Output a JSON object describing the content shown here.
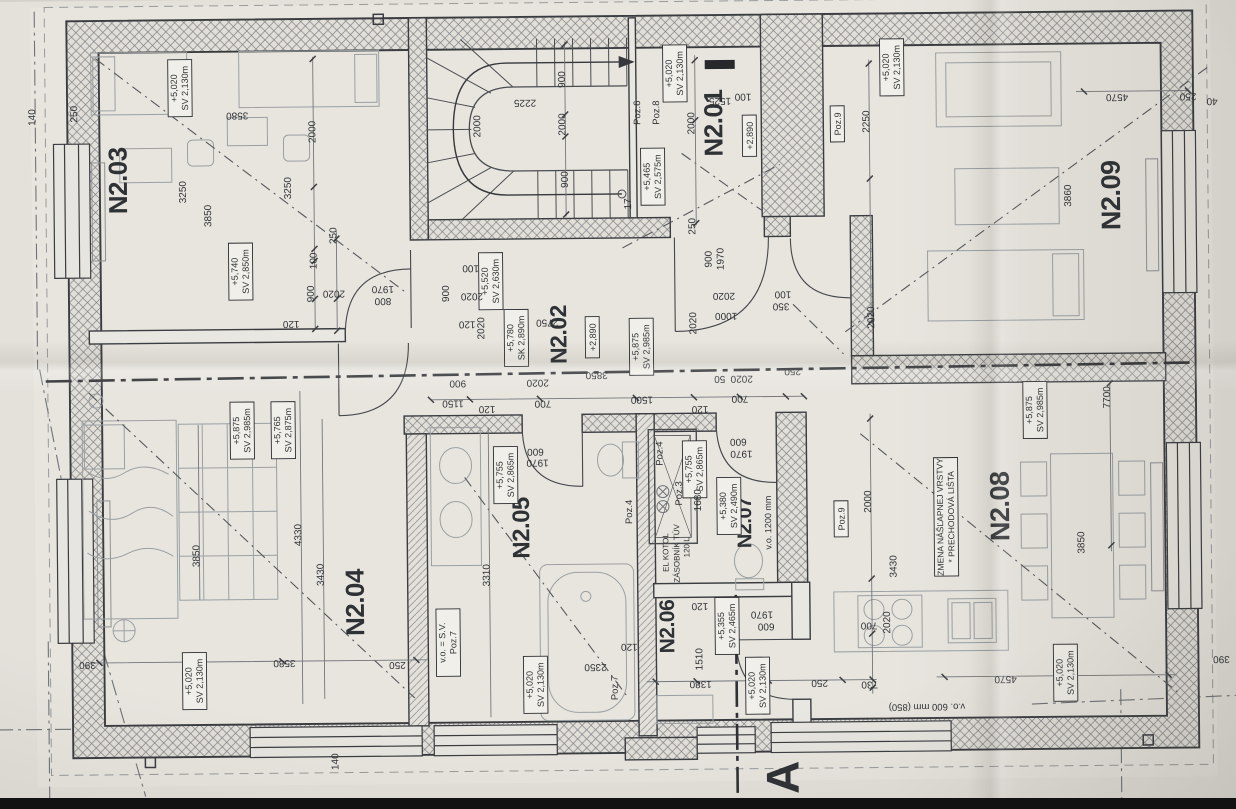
{
  "meta": {
    "description": "Photographed floor-plan drawing, 2nd floor, rooms N2.01–N2.09 with dimensions and level/height labels"
  },
  "plan": {
    "rooms": [
      {
        "t": "N2.03",
        "x": 135,
        "y": 180,
        "s": 26
      },
      {
        "t": "N2.01",
        "x": 731,
        "y": 128,
        "s": 26
      },
      {
        "t": "N2.09",
        "x": 1128,
        "y": 204,
        "s": 27
      },
      {
        "t": "N2.02",
        "x": 573,
        "y": 338,
        "s": 23
      },
      {
        "t": "N2.04",
        "x": 368,
        "y": 604,
        "s": 26
      },
      {
        "t": "N2.05",
        "x": 534,
        "y": 531,
        "s": 24
      },
      {
        "t": "N2.07",
        "x": 756,
        "y": 528,
        "s": 20
      },
      {
        "t": "N2.06",
        "x": 678,
        "y": 631,
        "s": 21
      },
      {
        "t": "N2.08",
        "x": 1014,
        "y": 514,
        "s": 27
      }
    ],
    "elevations": [
      {
        "l1": "+5,020",
        "l2": "SV 2,130m",
        "x": 189,
        "y": 88
      },
      {
        "l1": "+5,740",
        "l2": "SV 2,850m",
        "x": 248,
        "y": 272
      },
      {
        "l1": "+5,465",
        "l2": "SV 2,575m",
        "x": 661,
        "y": 181
      },
      {
        "l1": "+5,020",
        "l2": "SV 2,130m",
        "x": 684,
        "y": 78
      },
      {
        "l1": "+2,890",
        "l2": null,
        "x": 758,
        "y": 141
      },
      {
        "l1": "+5,020",
        "l2": "SV 2,130m",
        "x": 901,
        "y": 74
      },
      {
        "l1": "+5,520",
        "l2": "SV 2,630m",
        "x": 498,
        "y": 284
      },
      {
        "l1": "+5,780",
        "l2": "SK 2,890m",
        "x": 523,
        "y": 341
      },
      {
        "l1": "+2,890",
        "l2": null,
        "x": 599,
        "y": 341
      },
      {
        "l1": "+5,875",
        "l2": "SV 2,985m",
        "x": 648,
        "y": 351
      },
      {
        "l1": "+5,875",
        "l2": "SV 2,985m",
        "x": 248,
        "y": 431
      },
      {
        "l1": "+5,765",
        "l2": "SV 2,875m",
        "x": 289,
        "y": 431
      },
      {
        "l1": "+5,020",
        "l2": "SV 2,130m",
        "x": 198,
        "y": 681
      },
      {
        "l1": "v.o. = S.V.",
        "l2": "Poz.7",
        "x": 452,
        "y": 645
      },
      {
        "l1": "+5,755",
        "l2": "SV 2,865m",
        "x": 511,
        "y": 478
      },
      {
        "l1": "+5,020",
        "l2": "SV 2,130m",
        "x": 539,
        "y": 688
      },
      {
        "l1": "+5,380",
        "l2": "SV 2,490m",
        "x": 734,
        "y": 511
      },
      {
        "l1": "+5,755",
        "l2": "SV 2,865m",
        "x": 700,
        "y": 474
      },
      {
        "l1": "+5,355",
        "l2": "SV 2,465m",
        "x": 731,
        "y": 631
      },
      {
        "l1": "+5,020",
        "l2": "SV 2,130m",
        "x": 761,
        "y": 691
      },
      {
        "l1": "+5,875",
        "l2": "SV 2,985m",
        "x": 1041,
        "y": 418
      },
      {
        "l1": "+5,020",
        "l2": "SV 2,130m",
        "x": 1069,
        "y": 681
      }
    ],
    "note": {
      "l1": "ZMENA NÁŠĽAPNEJ VRSTVY",
      "l2": "* PRECHODOVÁ LIŠTA",
      "x": 951,
      "y": 524
    },
    "labels": [
      {
        "t": "Poz.6",
        "x": 649,
        "y": 117,
        "r": "u"
      },
      {
        "t": "Poz.8",
        "x": 668,
        "y": 117,
        "r": "u"
      },
      {
        "t": "Poz.9",
        "x": 846,
        "y": 130,
        "r": "u",
        "box": 1
      },
      {
        "t": "Poz.9",
        "x": 846,
        "y": 525,
        "r": "u",
        "box": 1
      },
      {
        "t": "Poz.4",
        "x": 637,
        "y": 516,
        "r": "u"
      },
      {
        "t": "Poz.7",
        "x": 621,
        "y": 692,
        "r": "u"
      },
      {
        "t": "Poz.4",
        "x": 668,
        "y": 458,
        "r": "u"
      },
      {
        "t": "Poz.3",
        "x": 687,
        "y": 498,
        "r": "u"
      },
      {
        "t": "v.o. 1200 mm",
        "x": 776,
        "y": 528,
        "r": "u",
        "s": 9
      },
      {
        "t": "EL KOTOL",
        "x": 673,
        "y": 557,
        "r": "u",
        "s": 8
      },
      {
        "t": "ZÁSOBNÍK TÚV",
        "x": 684,
        "y": 558,
        "r": "u",
        "s": 8
      },
      {
        "t": "120 L",
        "x": 694,
        "y": 552,
        "r": "u",
        "s": 8
      },
      {
        "t": "v.o. 600 mm (850)",
        "x": 930,
        "y": 711,
        "r": "d",
        "s": 9.5
      },
      {
        "t": "17",
        "x": 639,
        "y": 208,
        "r": "u",
        "s": 10
      },
      {
        "t": "A",
        "x": 801,
        "y": 783,
        "r": "u",
        "s": 46,
        "b": 1
      }
    ],
    "dims": [
      [
        "3580",
        246,
        113,
        "d"
      ],
      [
        "2000",
        324,
        133,
        "u"
      ],
      [
        "3250",
        194,
        192,
        "u"
      ],
      [
        "3850",
        219,
        216,
        "u"
      ],
      [
        "3250",
        299,
        189,
        "u"
      ],
      [
        "250",
        344,
        237,
        "u"
      ],
      [
        "100",
        324,
        262,
        "u"
      ],
      [
        "900",
        321,
        295,
        "u"
      ],
      [
        "2020",
        341,
        292,
        "d"
      ],
      [
        "1970",
        390,
        288,
        "d"
      ],
      [
        "800",
        390,
        300,
        "d"
      ],
      [
        "120",
        298,
        322,
        "d"
      ],
      [
        "140",
        44,
        116,
        "u"
      ],
      [
        "250",
        86,
        113,
        "u"
      ],
      [
        "900",
        574,
        83,
        "u"
      ],
      [
        "2225",
        534,
        103,
        "d"
      ],
      [
        "2000",
        489,
        129,
        "u"
      ],
      [
        "2000",
        574,
        128,
        "u"
      ],
      [
        "900",
        576,
        183,
        "u"
      ],
      [
        "250",
        703,
        231,
        "u"
      ],
      [
        "1525",
        729,
        103,
        "d"
      ],
      [
        "100",
        752,
        99,
        "d"
      ],
      [
        "2000",
        703,
        128,
        "u"
      ],
      [
        "900",
        719,
        264,
        "u"
      ],
      [
        "1970",
        731,
        264,
        "u"
      ],
      [
        "2020",
        731,
        298,
        "d"
      ],
      [
        "1000",
        733,
        318,
        "d"
      ],
      [
        "100",
        790,
        297,
        "d"
      ],
      [
        "350",
        788,
        309,
        "d"
      ],
      [
        "2250",
        878,
        128,
        "u"
      ],
      [
        "4570",
        1126,
        103,
        "d"
      ],
      [
        "3860",
        1079,
        204,
        "u"
      ],
      [
        "2020",
        881,
        324,
        "u"
      ],
      [
        "250",
        1197,
        103,
        "d"
      ],
      [
        "40",
        1221,
        108,
        "d"
      ],
      [
        "900",
        456,
        296,
        "u"
      ],
      [
        "100",
        478,
        268,
        "d"
      ],
      [
        "2020",
        479,
        296,
        "d"
      ],
      [
        "120",
        474,
        324,
        "d"
      ],
      [
        "2020",
        491,
        331,
        "u"
      ],
      [
        "2750",
        554,
        323,
        "d"
      ],
      [
        "3850",
        603,
        376,
        "d"
      ],
      [
        "2020",
        544,
        383,
        "d"
      ],
      [
        "900",
        464,
        383,
        "d"
      ],
      [
        "2020",
        703,
        328,
        "u"
      ],
      [
        "50",
        726,
        381,
        "d"
      ],
      [
        "2020",
        748,
        381,
        "d"
      ],
      [
        "250",
        799,
        374,
        "d"
      ],
      [
        "700",
        746,
        401,
        "d"
      ],
      [
        "1500",
        648,
        401,
        "d"
      ],
      [
        "700",
        549,
        404,
        "d"
      ],
      [
        "1150",
        459,
        403,
        "d"
      ],
      [
        "120",
        493,
        409,
        "d"
      ],
      [
        "120",
        706,
        411,
        "d"
      ],
      [
        "3850",
        204,
        556,
        "u"
      ],
      [
        "4330",
        306,
        536,
        "u"
      ],
      [
        "3430",
        328,
        576,
        "u"
      ],
      [
        "3580",
        288,
        661,
        "d"
      ],
      [
        "390",
        91,
        661,
        "d"
      ],
      [
        "250",
        401,
        664,
        "d"
      ],
      [
        "140",
        341,
        763,
        "u"
      ],
      [
        "3310",
        494,
        578,
        "u"
      ],
      [
        "2350",
        599,
        668,
        "d"
      ],
      [
        "120",
        633,
        648,
        "d"
      ],
      [
        "600",
        541,
        452,
        "d"
      ],
      [
        "1970",
        543,
        463,
        "d"
      ],
      [
        "600",
        744,
        444,
        "d"
      ],
      [
        "1970",
        747,
        456,
        "d"
      ],
      [
        "1680",
        706,
        505,
        "u"
      ],
      [
        "1510",
        706,
        664,
        "u"
      ],
      [
        "600",
        770,
        629,
        "d"
      ],
      [
        "1970",
        766,
        617,
        "d"
      ],
      [
        "1380",
        704,
        686,
        "d"
      ],
      [
        "120",
        704,
        608,
        "d"
      ],
      [
        "250",
        823,
        686,
        "d"
      ],
      [
        "7700",
        1116,
        406,
        "u"
      ],
      [
        "3850",
        1089,
        551,
        "u"
      ],
      [
        "4570",
        1009,
        684,
        "d"
      ],
      [
        "2000",
        876,
        508,
        "u"
      ],
      [
        "3430",
        901,
        573,
        "u"
      ],
      [
        "2020",
        894,
        629,
        "u"
      ],
      [
        "700",
        873,
        629,
        "d"
      ],
      [
        "730",
        873,
        688,
        "d"
      ],
      [
        "390",
        1225,
        666,
        "d"
      ]
    ]
  }
}
